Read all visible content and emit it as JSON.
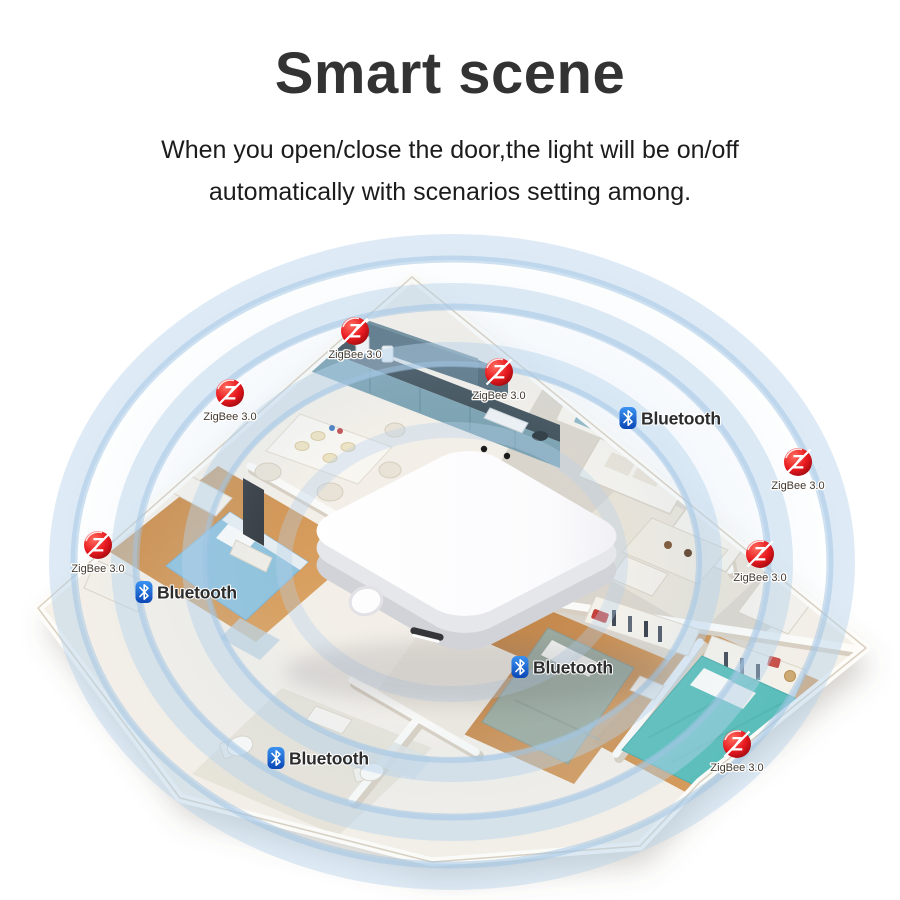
{
  "header": {
    "title": "Smart scene",
    "subtitle_line1": "When you open/close the door,the light will be on/off",
    "subtitle_line2": "automatically with scenarios setting among."
  },
  "diagram": {
    "labels": {
      "zigbee": "ZigBee 3.0",
      "bluetooth": "Bluetooth",
      "zigbee_letter": "Z"
    },
    "badges": {
      "zigbee_count": 7,
      "bluetooth_count": 4
    },
    "hub": {
      "led_count": 2
    },
    "colors": {
      "zigbee_red": "#d8161d",
      "bluetooth_blue": "#1257c4",
      "signal_ring_blue": "#aecbe8",
      "hub_white": "#ffffff"
    }
  }
}
